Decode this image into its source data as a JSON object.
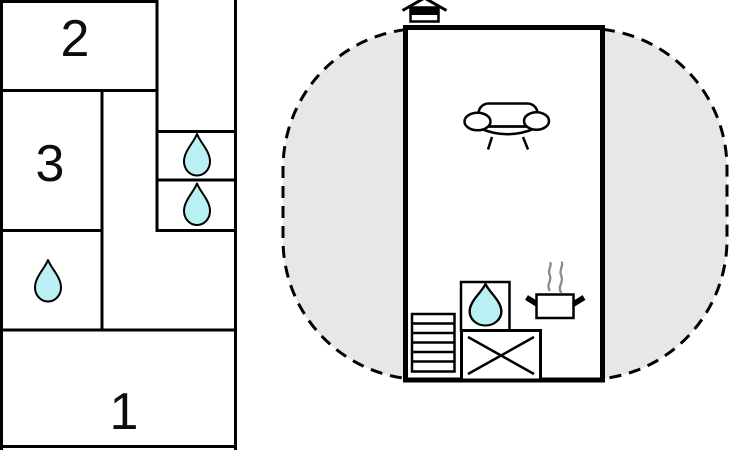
{
  "title": "Floor plan",
  "left_unit": {
    "rooms": [
      {
        "id": "room-2",
        "label": "2"
      },
      {
        "id": "room-3",
        "label": "3"
      },
      {
        "id": "room-1",
        "label": "1"
      }
    ],
    "water_drop_count": 3
  },
  "main_unit": {
    "water_drop_count": 1,
    "icons": [
      "chimney",
      "sofa",
      "shelf",
      "sink",
      "crossed-box",
      "stove-pot",
      "steam"
    ]
  },
  "colors": {
    "wall": "#000000",
    "plot_fill": "#e7e7ea",
    "water_drop_fill": "#b9f0f3",
    "steam": "#8a8a8a",
    "background": "#ffffff"
  }
}
